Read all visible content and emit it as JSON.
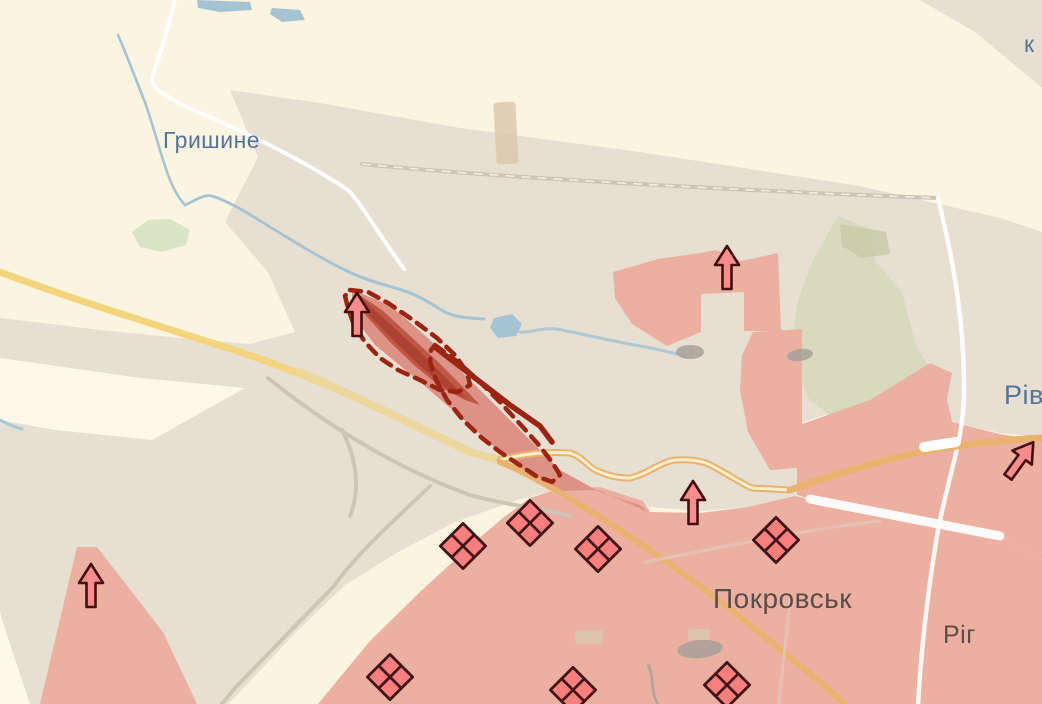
{
  "map": {
    "labels": {
      "hryshyne": "Гришине",
      "pokrovsk": "Покровськ",
      "riv_partial": "Рів",
      "rih_partial": "Ріг",
      "k_partial": "к"
    },
    "symbols": {
      "advance_arrow": "up-arrow",
      "assault_diamond": "crossed-diamond",
      "advance_arrow_count": 5,
      "assault_diamond_count": 7
    },
    "colors": {
      "background": "#faf4e1",
      "fields_light": "#fdf9ea",
      "gray_zone": "#e7dfd2",
      "forest": "#d8dabe",
      "forest_light": "#d7e5c5",
      "forest_dark": "#c8cba8",
      "enemy_control": "#ecb0a1",
      "advance_light": "#dc9284",
      "advance_mid": "#c05744",
      "advance_dark": "#ad4132",
      "advance_outline": "#9c2412",
      "arrow_fill": "#f98c8c",
      "arrow_outline": "#44100f",
      "diamond_fill": "#f97f7f",
      "diamond_outline": "#421418",
      "road_yellow": "#f3d57e",
      "road_pale_yellow": "#ecd79c",
      "road_core": "#f8eecb",
      "road_orange": "#e9b26e",
      "road_white": "#ffffff",
      "road_faint": "#e6c3b4",
      "railway": "#cdc6b8",
      "water": "#a4c4d4",
      "building_gray": "#a7a19a",
      "building_tan": "#d9c9ae",
      "label_blue": "#53749b",
      "label_dark": "#5b4c4a"
    }
  }
}
